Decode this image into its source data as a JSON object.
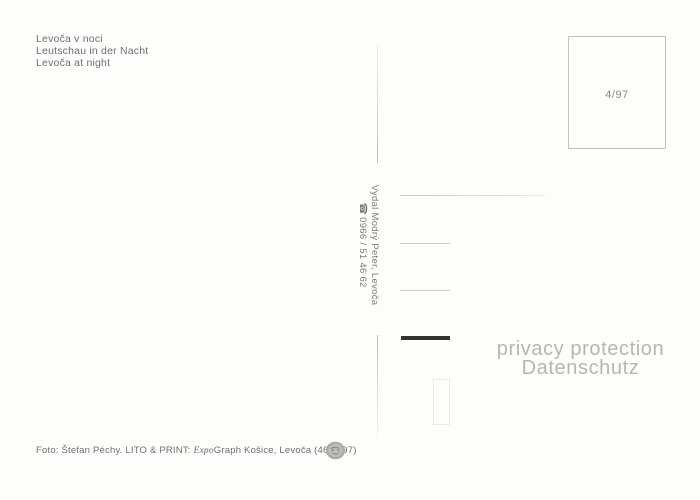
{
  "postcard": {
    "titles": [
      "Levoča v noci",
      "Leutschau in der Nacht",
      "Levoča at night"
    ],
    "stamp_box_label": "4/97",
    "publisher": {
      "name_line": "Vydal Modrý Peter, Levoča",
      "phone_icon": "☎",
      "phone_number": "0966 / 51 46 62"
    },
    "watermark": [
      "privacy protection",
      "Datenschutz"
    ],
    "footer": {
      "credit_prefix": "Foto: Štefan Péchy. LITO & PRINT: ",
      "brand_italic": "Expo",
      "brand_suffix": "Graph Košice, Levoča (4603/97)"
    },
    "colors": {
      "ink": "#6e6e6e",
      "rule_line": "#cbcbc8",
      "watermark": "#b5b5b3",
      "redaction_bar": "#333331"
    }
  }
}
